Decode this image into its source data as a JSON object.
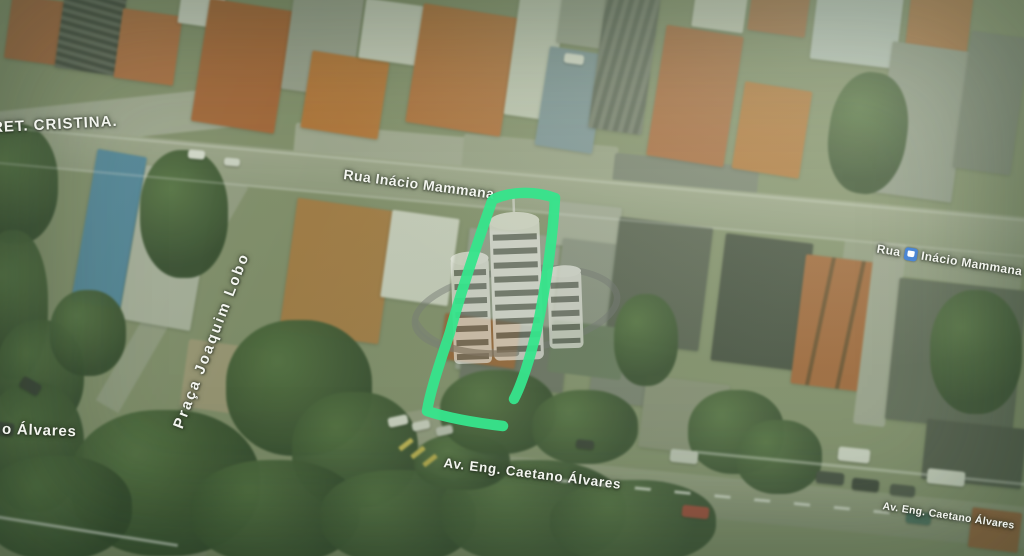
{
  "street_labels": {
    "top_left": "RET. CRISTINA.",
    "main_center": "Rua Inácio Mammana",
    "main_right_prefix": "Rua",
    "main_right_rest": "Inácio Mammana",
    "praca": "Praça Joaquim Lobo",
    "avenue_partial_left": "o Álvares",
    "avenue_center": "Av. Eng. Caetano Álvares",
    "avenue_right": "Av. Eng. Caetano Álvares"
  },
  "annotation": {
    "description": "hand-drawn green outline around property lot",
    "color": "#36e58c"
  },
  "watermark": {
    "description": "three-tower building logo with orbit ring",
    "building_color": "#ecede6",
    "ring_color": "#777c76"
  },
  "icons": {
    "transit_badge": "bus-transit-icon",
    "transit_badge_color": "#4b86d4"
  },
  "map_colors": {
    "terrain": "#87926f",
    "road": "#9ba387",
    "roof_orange": "#bd6c36",
    "tree_dark": "#2f4826",
    "label_halo": "rgba(45,55,40,0.9)"
  }
}
